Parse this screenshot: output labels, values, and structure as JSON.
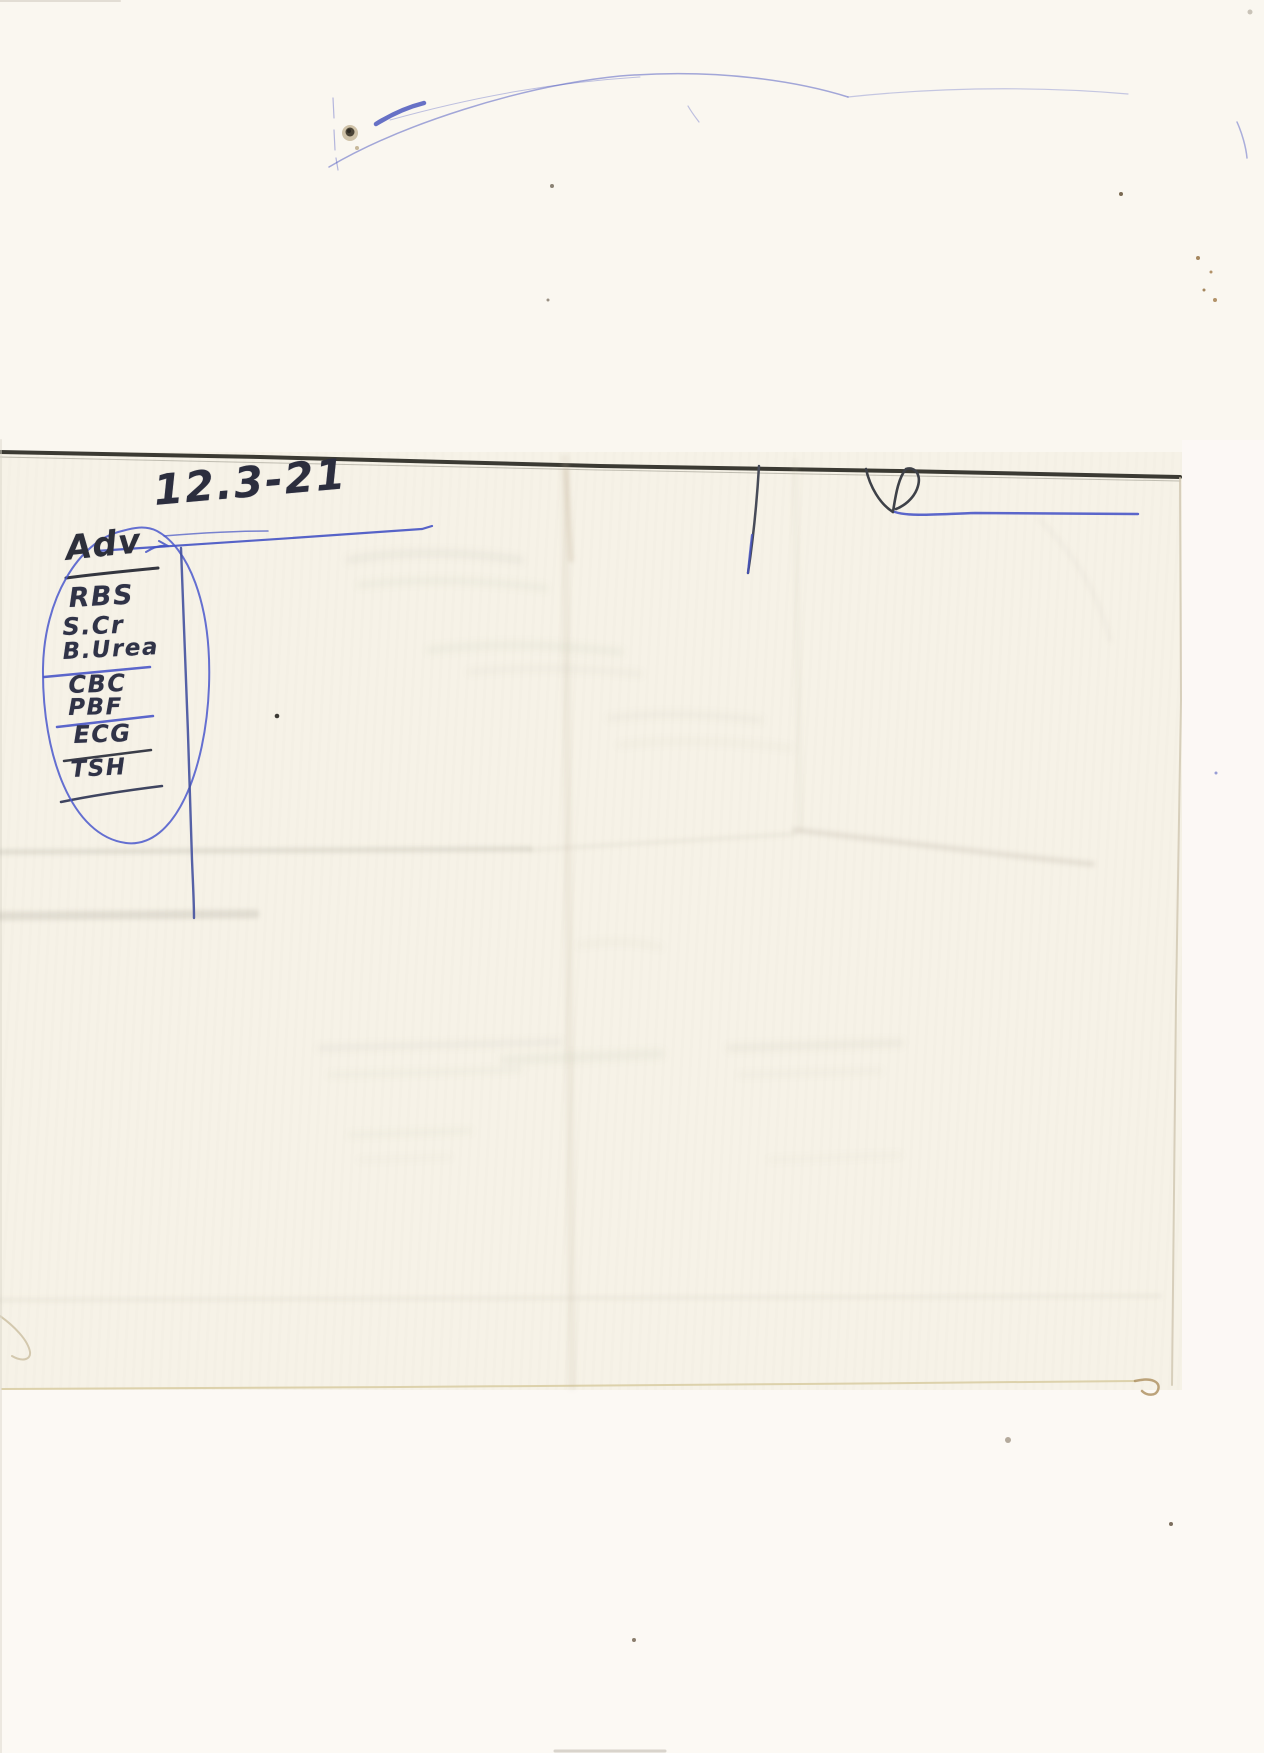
{
  "note": {
    "date": "12.3-21",
    "heading": "Adv",
    "advised_tests": [
      "RBS",
      "S.Cr",
      "B.Urea",
      "CBC",
      "PBF",
      "ECG",
      "TSH"
    ]
  },
  "marks": {
    "signature_glyph": "R",
    "ink_blue": "#4352c4",
    "ink_dark": "#33364a",
    "paper_edge_dark": "#3b3a33",
    "paper_color": "#f6f2e7",
    "background_color": "#fbf8f2"
  }
}
